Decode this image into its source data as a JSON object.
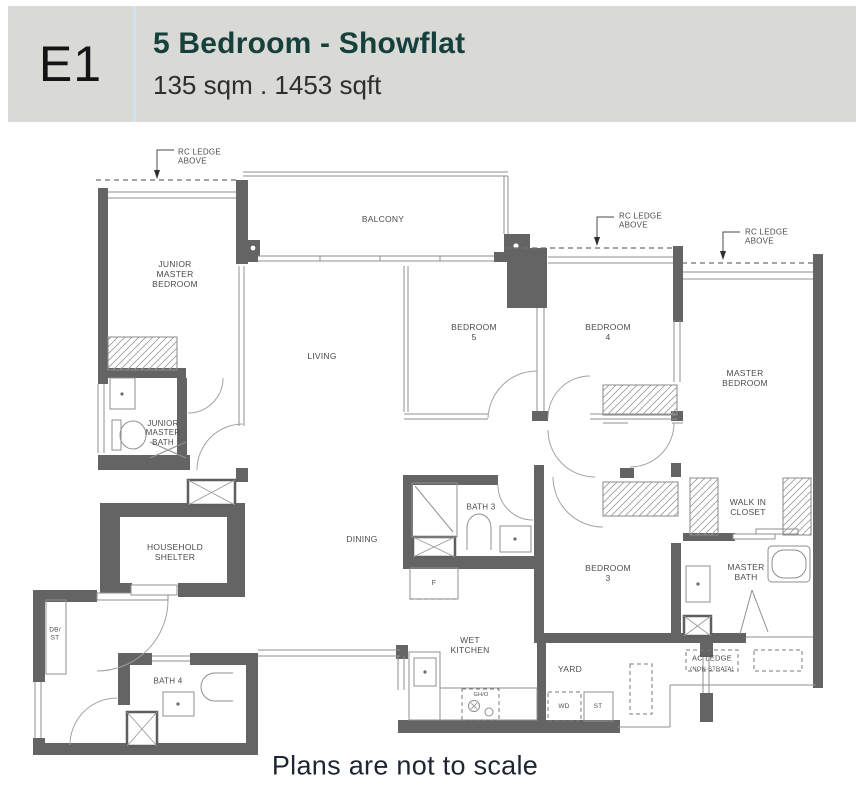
{
  "header": {
    "unit_code": "E1",
    "title": "5 Bedroom - Showflat",
    "subtitle": "135 sqm . 1453 sqft"
  },
  "footer": {
    "note": "Plans are not to scale"
  },
  "colors": {
    "header_bg": "#d9d9d6",
    "divider": "#cfe4f2",
    "title": "#15403c",
    "subtitle": "#2e2e2e",
    "wall": "#646464",
    "label": "#4c4c4c",
    "footer_text": "#1d2533"
  },
  "floorplan": {
    "labels": [
      {
        "id": "rc-ledge-1",
        "text": "RC LEDGE\nABOVE",
        "x": 178,
        "y": 157,
        "fs": 8,
        "align": "left"
      },
      {
        "id": "rc-ledge-2",
        "text": "RC LEDGE\nABOVE",
        "x": 619,
        "y": 221,
        "fs": 8,
        "align": "left"
      },
      {
        "id": "rc-ledge-3",
        "text": "RC LEDGE\nABOVE",
        "x": 745,
        "y": 237,
        "fs": 8,
        "align": "left"
      },
      {
        "id": "balcony",
        "text": "BALCONY",
        "x": 383,
        "y": 219,
        "fs": 8.5
      },
      {
        "id": "junior-master-bedroom",
        "text": "JUNIOR\nMASTER\nBEDROOM",
        "x": 175,
        "y": 274,
        "fs": 8.5
      },
      {
        "id": "living",
        "text": "LIVING",
        "x": 322,
        "y": 356,
        "fs": 8.5
      },
      {
        "id": "bedroom-5",
        "text": "BEDROOM\n5",
        "x": 474,
        "y": 332,
        "fs": 8.5
      },
      {
        "id": "bedroom-4",
        "text": "BEDROOM\n4",
        "x": 608,
        "y": 332,
        "fs": 8.5
      },
      {
        "id": "master-bedroom",
        "text": "MASTER\nBEDROOM",
        "x": 745,
        "y": 378,
        "fs": 8.5
      },
      {
        "id": "junior-master-bath",
        "text": "JUNIOR\nMASTER\nBATH",
        "x": 163,
        "y": 433,
        "fs": 8
      },
      {
        "id": "household-shelter",
        "text": "HOUSEHOLD\nSHELTER",
        "x": 175,
        "y": 552,
        "fs": 8.5
      },
      {
        "id": "dining",
        "text": "DINING",
        "x": 362,
        "y": 539,
        "fs": 8.5
      },
      {
        "id": "bath-3",
        "text": "BATH 3",
        "x": 481,
        "y": 507,
        "fs": 8
      },
      {
        "id": "bedroom-3",
        "text": "BEDROOM\n3",
        "x": 608,
        "y": 573,
        "fs": 8.5
      },
      {
        "id": "walk-in-closet",
        "text": "WALK IN\nCLOSET",
        "x": 748,
        "y": 507,
        "fs": 8.5
      },
      {
        "id": "master-bath",
        "text": "MASTER\nBATH",
        "x": 746,
        "y": 572,
        "fs": 8.5
      },
      {
        "id": "db-st",
        "text": "DB/\nST",
        "x": 55,
        "y": 634,
        "fs": 6.5
      },
      {
        "id": "bath-4",
        "text": "BATH 4",
        "x": 168,
        "y": 681,
        "fs": 8
      },
      {
        "id": "wet-kitchen",
        "text": "WET\nKITCHEN",
        "x": 470,
        "y": 645,
        "fs": 8.5
      },
      {
        "id": "yard",
        "text": "YARD",
        "x": 570,
        "y": 669,
        "fs": 8.5
      },
      {
        "id": "fridge",
        "text": "F",
        "x": 434,
        "y": 584,
        "fs": 7
      },
      {
        "id": "hob",
        "text": "GH/O",
        "x": 481,
        "y": 695,
        "fs": 5.5
      },
      {
        "id": "washer-dryer",
        "text": "WD",
        "x": 564,
        "y": 707,
        "fs": 6.5
      },
      {
        "id": "storage",
        "text": "ST",
        "x": 598,
        "y": 707,
        "fs": 6.5
      },
      {
        "id": "ac-ledge",
        "text": "AC LEDGE",
        "x": 712,
        "y": 659,
        "fs": 7.5
      },
      {
        "id": "ac-ledge-sub",
        "text": "(NON-STRATA)",
        "x": 712,
        "y": 670,
        "fs": 5.8
      }
    ]
  }
}
